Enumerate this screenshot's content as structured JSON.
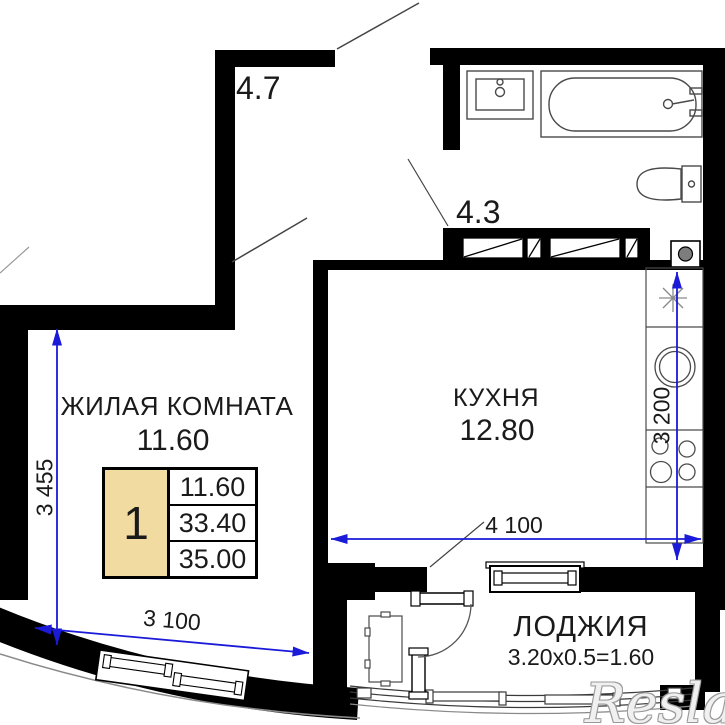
{
  "meta": {
    "title": "apartment floor plan",
    "width": 725,
    "height": 725,
    "background": "#ffffff"
  },
  "colors": {
    "wall": "#000000",
    "dimension_blue": "#1a1ad8",
    "fixture_line": "#4a4a4a",
    "table_highlight": "#f2dba1",
    "text": "#1a1a1a"
  },
  "rooms": [
    {
      "id": "living-room",
      "name": "ЖИЛАЯ КОМНАТА",
      "area": "11.60"
    },
    {
      "id": "kitchen",
      "name": "КУХНЯ",
      "area": "12.80"
    },
    {
      "id": "loggia",
      "name": "ЛОДЖИЯ",
      "area_calc": "3.20x0.5=1.60"
    },
    {
      "id": "hallway",
      "name": "",
      "area": "4.7"
    },
    {
      "id": "bathroom",
      "name": "",
      "area": "4.3"
    }
  ],
  "dimensions": [
    {
      "id": "living-height",
      "label": "3 455"
    },
    {
      "id": "living-width",
      "label": "3 100"
    },
    {
      "id": "kitchen-width",
      "label": "4 100"
    },
    {
      "id": "kitchen-height",
      "label": "3 200"
    }
  ],
  "info_table": {
    "flat_number": "1",
    "rows": [
      "11.60",
      "33.40",
      "35.00"
    ]
  },
  "watermark": {
    "text": "Reslate"
  },
  "fixtures": [
    "bath-sink",
    "bathtub",
    "toilet",
    "washing-machine",
    "vent-shafts",
    "fridge-spot-snowflake",
    "kitchen-sink",
    "stove",
    "kitchen-counter",
    "loggia-table",
    "entry-door",
    "living-room-door",
    "loggia-door",
    "living-room-window",
    "kitchen-loggia-window",
    "loggia-glazing"
  ]
}
